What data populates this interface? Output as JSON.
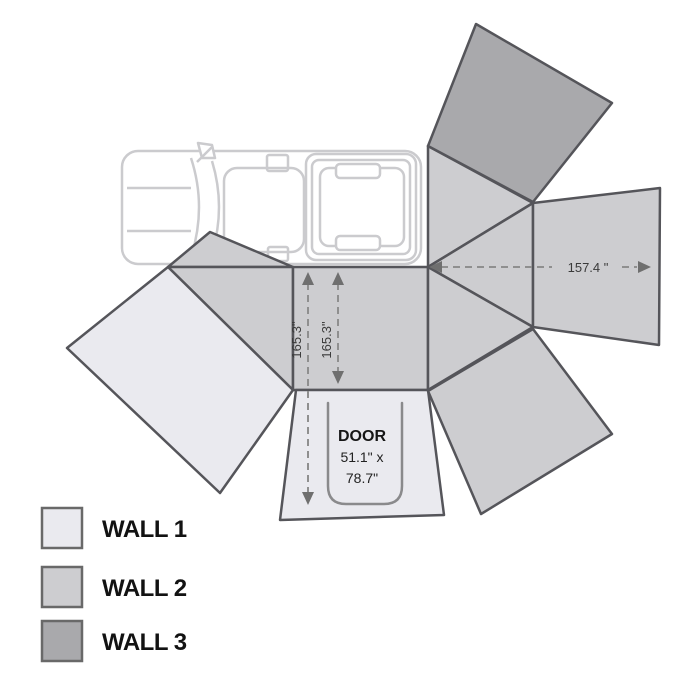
{
  "colors": {
    "wall1": "#eaeaef",
    "wall2": "#cdcdd0",
    "wall3": "#a9a9ac"
  },
  "dimensions": {
    "awning_width": "157.4 \"",
    "awning_height_left": "165.3\"",
    "awning_height_right": "165.3\""
  },
  "door": {
    "title": "DOOR",
    "size_line1": "51.1\" x",
    "size_line2": "78.7\""
  },
  "legend": {
    "items": [
      {
        "label": "WALL 1",
        "color": "#eaeaef"
      },
      {
        "label": "WALL 2",
        "color": "#cdcdd0"
      },
      {
        "label": "WALL 3",
        "color": "#a9a9ac"
      }
    ]
  }
}
